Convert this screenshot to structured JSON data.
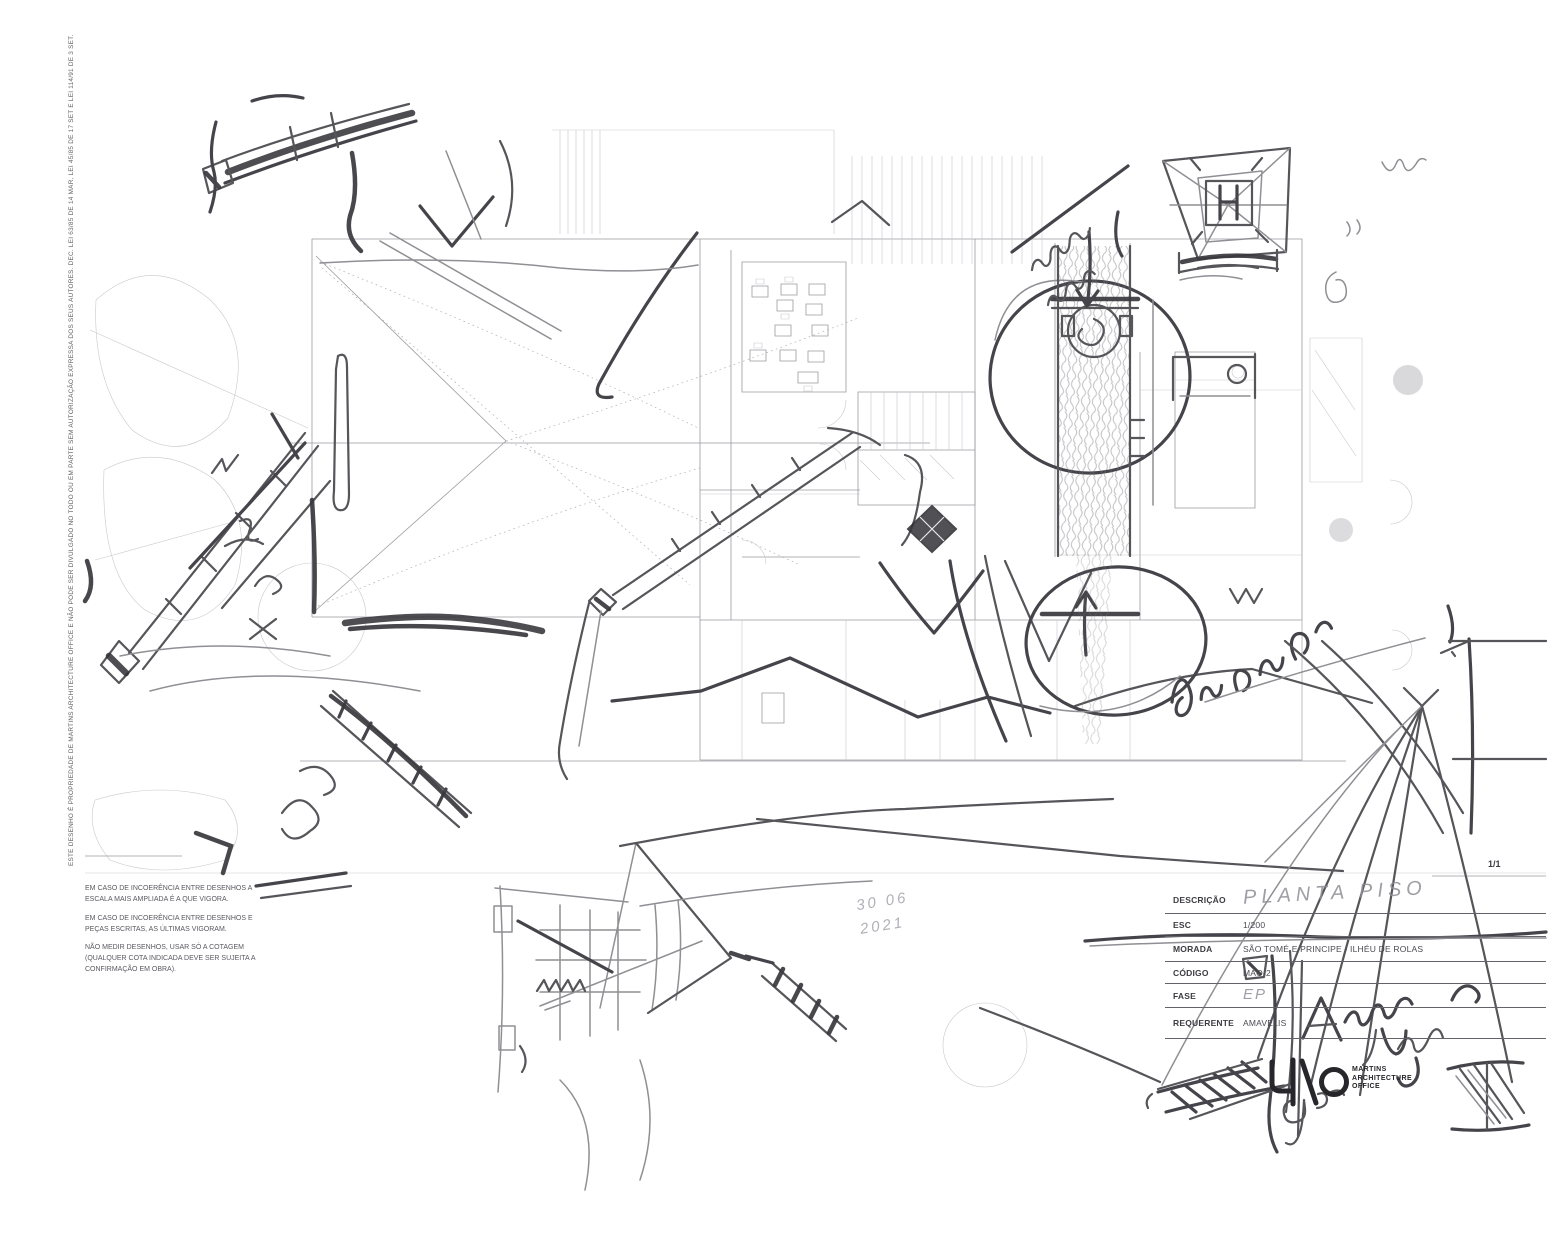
{
  "sheet": {
    "number": "1/1"
  },
  "copyright": "ESTE DESENHO É PROPRIEDADE DE MARTINS ARCHITECTURE OFFICE E NÃO PODE SER DIVULGADO NO TODO OU EM PARTE SEM AUTORIZAÇÃO EXPRESSA DOS SEUS AUTORES. DEC. LEI 63/85 DE 14 MAR, LEI 45/85 DE 17 SET E LEI 114/91 DE 3 SET.",
  "disclaimers": [
    "EM CASO DE INCOERÊNCIA ENTRE DESENHOS A ESCALA MAIS AMPLIADA É A QUE VIGORA.",
    "EM CASO DE INCOERÊNCIA ENTRE DESENHOS E PEÇAS ESCRITAS, AS ÚLTIMAS VIGORAM.",
    "NÃO MEDIR DESENHOS, USAR SÓ A COTAGEM (QUALQUER COTA INDICADA DEVE SER SUJEITA A CONFIRMAÇÃO EM OBRA)."
  ],
  "title_block": {
    "rows": [
      {
        "label": "DESCRIÇÃO",
        "value": ""
      },
      {
        "label": "ESC",
        "value": "1/200"
      },
      {
        "label": "MORADA",
        "value": "SÃO TOMÉ E PRINCIPE - ILHÉU DE ROLAS"
      },
      {
        "label": "CÓDIGO",
        "value": "MAO-2"
      },
      {
        "label": "FASE",
        "value": ""
      },
      {
        "label": "REQUERENTE",
        "value": "AMAVELIS"
      }
    ]
  },
  "handwritten": {
    "descricao": "PLANTA PISO",
    "fase": "EP",
    "date_line1": "30 06",
    "date_line2": "2021",
    "note_top": "remate conseguir",
    "note_right": "desnivelado!",
    "note_signature": "Alinhar vertical"
  },
  "logo": {
    "mark": "MAO",
    "line1": "MARTINS",
    "line2": "ARCHITECTURE",
    "line3": "OFFICE"
  },
  "colors": {
    "paper": "#ffffff",
    "cad": "#9b9ba1",
    "pencil": "#55555a",
    "pencil_dark": "#2f2f34"
  }
}
